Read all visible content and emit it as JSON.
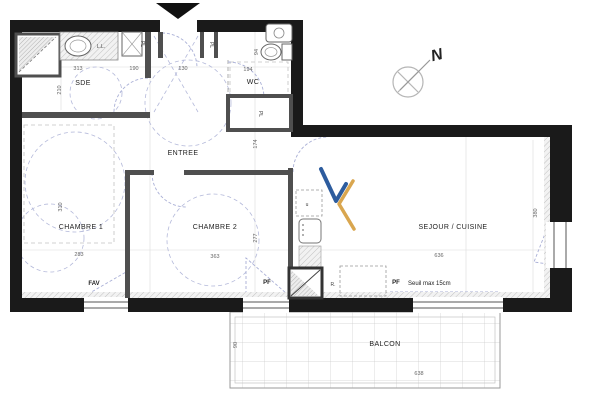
{
  "meta": {
    "type": "architectural-floor-plan",
    "description": "Apartment plan with balcony"
  },
  "rooms": {
    "sde": "SDE",
    "wc": "WC",
    "entree": "ENTREE",
    "chambre1": "CHAMBRE 1",
    "chambre2": "CHAMBRE 2",
    "sejour": "SEJOUR / CUISINE",
    "balcon": "BALCON"
  },
  "labels": {
    "ll": "L.L.",
    "pl_sde": "PL",
    "pl_entree": "PL",
    "pl_closet": "PL",
    "kitchen_u": "u",
    "r": "R.",
    "fav": "FAV",
    "pf_left": "PF",
    "pf_right": "PF",
    "seuil": "Seuil max 15cm",
    "north": "N"
  },
  "dims": {
    "sde_w": "313",
    "sde_h": "210",
    "entree_a": "190",
    "entree_b": "130",
    "wc_w": "194",
    "wc_h": "94",
    "pl_h": "174",
    "ch1_h": "310",
    "ch2_h": "277",
    "ch1_w": "283",
    "ch2_w": "363",
    "sejour_w": "636",
    "sejour_h": "380",
    "balcon_w": "638",
    "balcon_h": "90"
  },
  "colors": {
    "outer_wall": "#1a1a1a",
    "inner_wall": "#4f4f4f",
    "dashed_guides": "#a9afd6",
    "logo_blue": "#2d5c9e",
    "logo_gold": "#d9a64f"
  }
}
